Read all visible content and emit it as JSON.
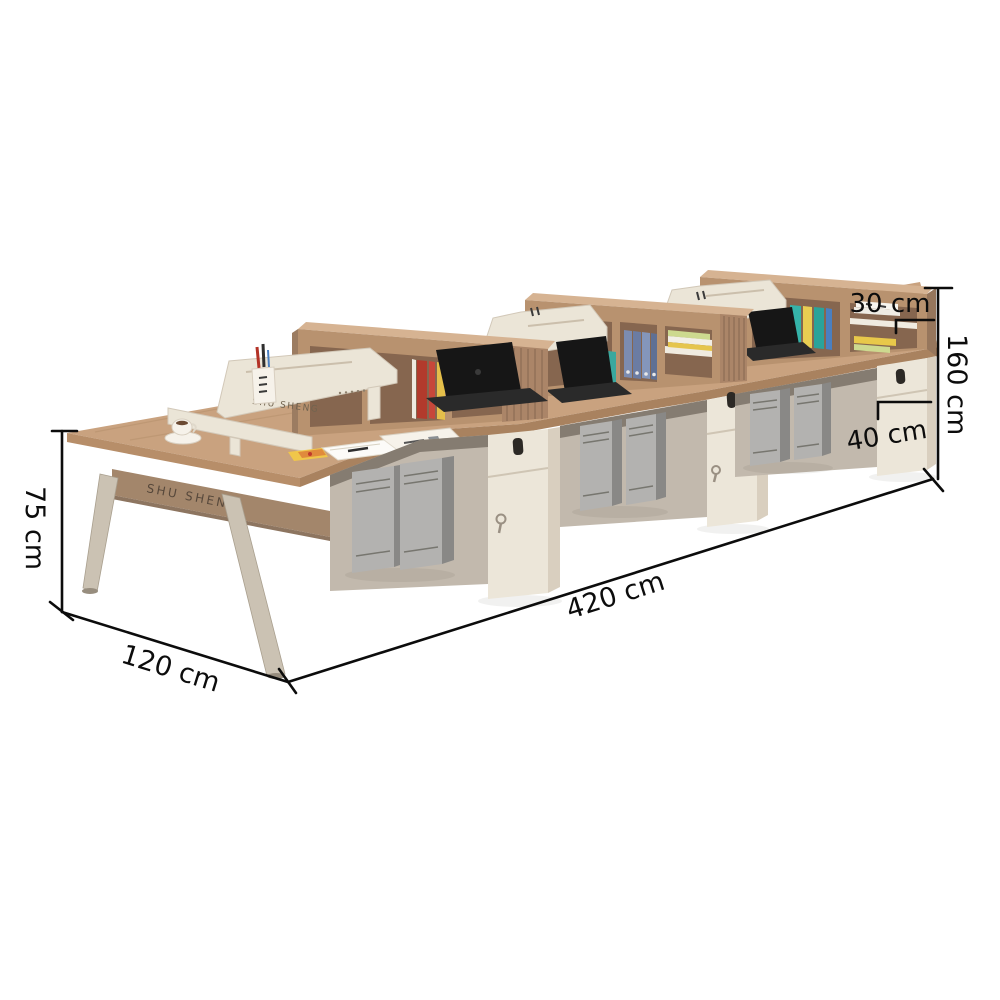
{
  "scene": {
    "description": "Product photo of a three-bay office workstation desk run with hutch shelving, pedestal cabinets and PC towers, annotated with black dimension lines",
    "background": "#ffffff",
    "brand_text": "SHU SHENG",
    "clock_display": "19:41"
  },
  "dimensions": {
    "desk_height": "75 cm",
    "desk_depth": "120 cm",
    "total_length": "420 cm",
    "total_height": "160 cm",
    "hutch_shelf_height": "30 cm",
    "cabinet_width": "40 cm"
  },
  "items": [
    "coffee cup and saucer",
    "desk divider screen with pen cup",
    "notepad and sticky notes",
    "digital clock",
    "books and binders on hutch shelves",
    "three laptops",
    "six PC towers",
    "three lockable pedestal cabinets"
  ],
  "colors": {
    "desktop_wood": "#c9a27f",
    "hutch_wood": "#b8926f",
    "cabinet_cream": "#ece6d9",
    "divider_cream": "#ebe5d7",
    "tower_gray": "#b3b2b0",
    "annotation_black": "#0c0c0c"
  }
}
